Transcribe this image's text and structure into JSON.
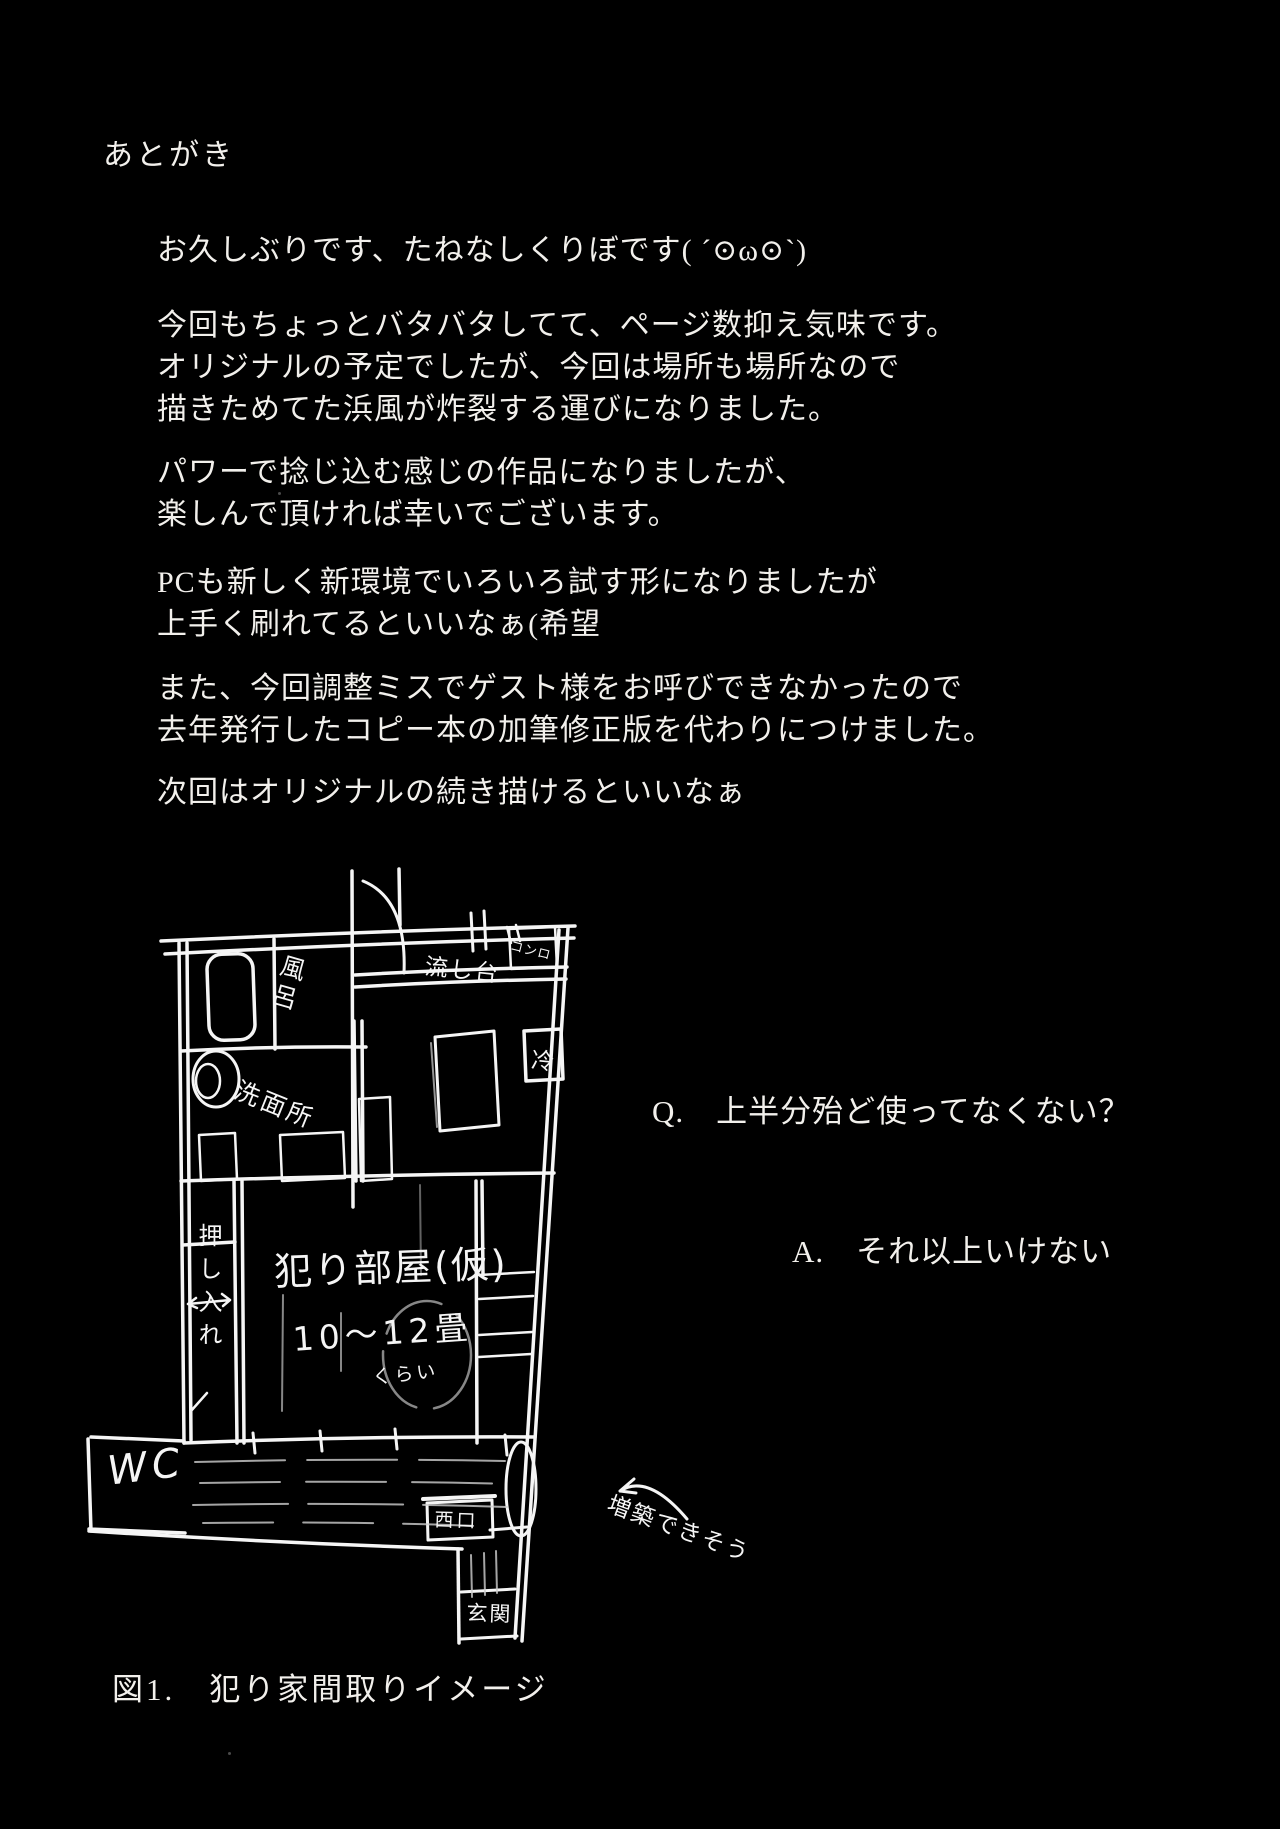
{
  "page": {
    "background": "#000000",
    "text_color": "#f2f0ec",
    "heading": "あとがき"
  },
  "afterword": {
    "paragraphs": [
      [
        "お久しぶりです、たねなしくりぼです( ´⊙ω⊙`)"
      ],
      [
        "今回もちょっとバタバタしてて、ページ数抑え気味です。",
        "オリジナルの予定でしたが、今回は場所も場所なので",
        "描きためてた浜風が炸裂する運びになりました。"
      ],
      [
        "パワーで捻じ込む感じの作品になりましたが、",
        "楽しんで頂ければ幸いでございます。"
      ],
      [
        "PCも新しく新環境でいろいろ試す形になりましたが",
        "上手く刷れてるといいなぁ(希望"
      ],
      [
        "また、今回調整ミスでゲスト様をお呼びできなかったので",
        "去年発行したコピー本の加筆修正版を代わりにつけました。"
      ],
      [
        "次回はオリジナルの続き描けるといいなぁ"
      ]
    ]
  },
  "qa": {
    "question": "Q.　上半分殆ど使ってなくない？",
    "answer": "A.　それ以上いけない"
  },
  "floorplan": {
    "caption": "図1.　犯り家間取りイメージ",
    "labels": {
      "bath": "風呂",
      "sink": "流し台",
      "stove": "コンロ",
      "fridge": "冷",
      "washroom": "洗面所",
      "closet": "押し入れ",
      "main_room": "犯り部屋(仮)",
      "room_size": "10〜12畳",
      "room_size_suffix": "くらい",
      "toilet": "WC",
      "side_door": "西口",
      "entrance": "玄関",
      "note": "増築できそう"
    }
  }
}
